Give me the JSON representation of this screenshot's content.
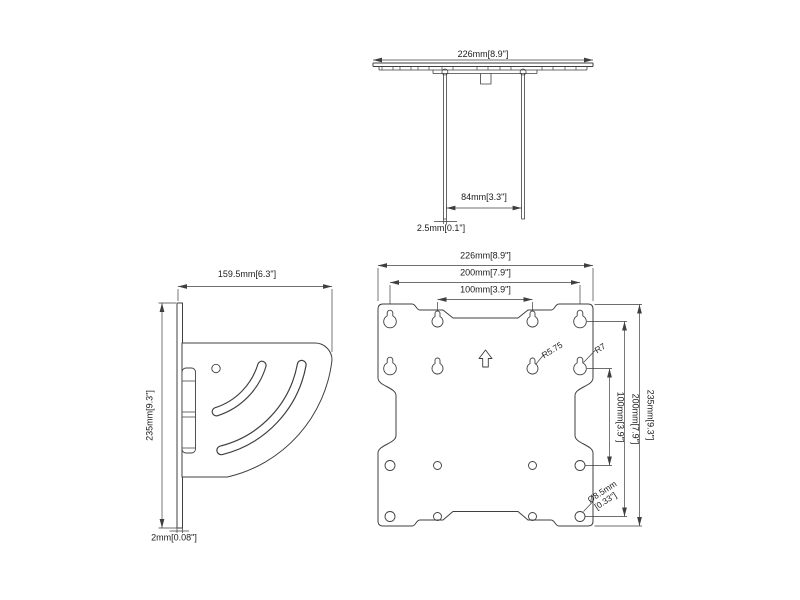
{
  "drawing": {
    "type": "TV wall mount bracket dimensional drawing",
    "background": "#ffffff",
    "line_color": "#3f3f3f",
    "text_color": "#1c1c1c"
  },
  "views": {
    "top": {
      "dim_width": "226mm[8.9\"]",
      "dim_leg_span": "84mm[3.3\"]",
      "dim_thickness": "2.5mm[0.1\"]"
    },
    "side": {
      "dim_depth": "159.5mm[6.3\"]",
      "dim_height": "235mm[9.3\"]",
      "dim_thickness": "2mm[0.08\"]"
    },
    "front": {
      "dim_width": "226mm[8.9\"]",
      "dim_vesa200_horizontal": "200mm[7.9\"]",
      "dim_vesa100_horizontal": "100mm[3.9\"]",
      "dim_vesa100_vertical": "100mm[3.9\"]",
      "dim_vesa200_vertical": "200mm[7.9\"]",
      "dim_height": "235mm[9.3\"]",
      "radius_inner_keyhole": "R5.75",
      "radius_outer_keyhole": "R7",
      "hole_diameter_line1": "Ø8.5mm",
      "hole_diameter_line2": "[0.33\"]"
    }
  }
}
